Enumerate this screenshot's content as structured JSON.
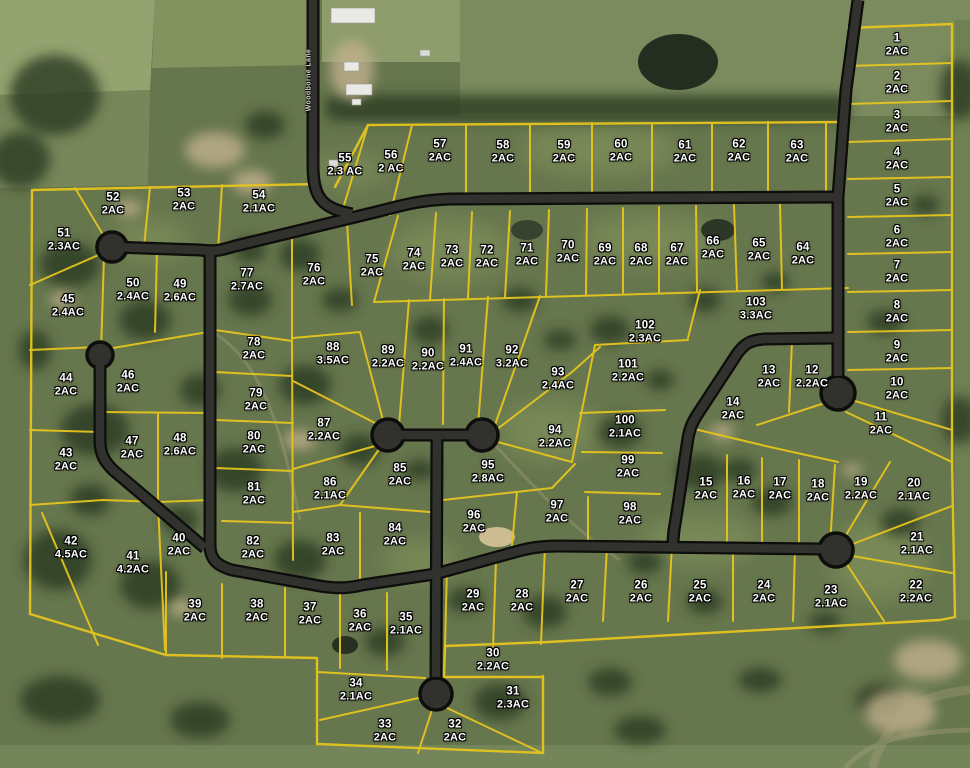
{
  "map": {
    "road_label": "Woodborne Lane"
  },
  "lots": [
    {
      "n": "1",
      "area": "2AC",
      "x": 897,
      "y": 45
    },
    {
      "n": "2",
      "area": "2AC",
      "x": 897,
      "y": 83
    },
    {
      "n": "3",
      "area": "2AC",
      "x": 897,
      "y": 122
    },
    {
      "n": "4",
      "area": "2AC",
      "x": 897,
      "y": 159
    },
    {
      "n": "5",
      "area": "2AC",
      "x": 897,
      "y": 196
    },
    {
      "n": "6",
      "area": "2AC",
      "x": 897,
      "y": 237
    },
    {
      "n": "7",
      "area": "2AC",
      "x": 897,
      "y": 272
    },
    {
      "n": "8",
      "area": "2AC",
      "x": 897,
      "y": 312
    },
    {
      "n": "9",
      "area": "2AC",
      "x": 897,
      "y": 352
    },
    {
      "n": "10",
      "area": "2AC",
      "x": 897,
      "y": 389
    },
    {
      "n": "11",
      "area": "2AC",
      "x": 881,
      "y": 424
    },
    {
      "n": "12",
      "area": "2.2AC",
      "x": 812,
      "y": 377
    },
    {
      "n": "13",
      "area": "2AC",
      "x": 769,
      "y": 377
    },
    {
      "n": "14",
      "area": "2AC",
      "x": 733,
      "y": 409
    },
    {
      "n": "15",
      "area": "2AC",
      "x": 706,
      "y": 489
    },
    {
      "n": "16",
      "area": "2AC",
      "x": 744,
      "y": 488
    },
    {
      "n": "17",
      "area": "2AC",
      "x": 780,
      "y": 489
    },
    {
      "n": "18",
      "area": "2AC",
      "x": 818,
      "y": 491
    },
    {
      "n": "19",
      "area": "2.2AC",
      "x": 861,
      "y": 489
    },
    {
      "n": "20",
      "area": "2.1AC",
      "x": 914,
      "y": 490
    },
    {
      "n": "21",
      "area": "2.1AC",
      "x": 917,
      "y": 544
    },
    {
      "n": "22",
      "area": "2.2AC",
      "x": 916,
      "y": 592
    },
    {
      "n": "23",
      "area": "2.1AC",
      "x": 831,
      "y": 597
    },
    {
      "n": "24",
      "area": "2AC",
      "x": 764,
      "y": 592
    },
    {
      "n": "25",
      "area": "2AC",
      "x": 700,
      "y": 592
    },
    {
      "n": "26",
      "area": "2AC",
      "x": 641,
      "y": 592
    },
    {
      "n": "27",
      "area": "2AC",
      "x": 577,
      "y": 592
    },
    {
      "n": "28",
      "area": "2AC",
      "x": 522,
      "y": 601
    },
    {
      "n": "29",
      "area": "2AC",
      "x": 473,
      "y": 601
    },
    {
      "n": "30",
      "area": "2.2AC",
      "x": 493,
      "y": 660
    },
    {
      "n": "31",
      "area": "2.3AC",
      "x": 513,
      "y": 698
    },
    {
      "n": "32",
      "area": "2AC",
      "x": 455,
      "y": 731
    },
    {
      "n": "33",
      "area": "2AC",
      "x": 385,
      "y": 731
    },
    {
      "n": "34",
      "area": "2.1AC",
      "x": 356,
      "y": 690
    },
    {
      "n": "35",
      "area": "2.1AC",
      "x": 406,
      "y": 624
    },
    {
      "n": "36",
      "area": "2AC",
      "x": 360,
      "y": 621
    },
    {
      "n": "37",
      "area": "2AC",
      "x": 310,
      "y": 614
    },
    {
      "n": "38",
      "area": "2AC",
      "x": 257,
      "y": 611
    },
    {
      "n": "39",
      "area": "2AC",
      "x": 195,
      "y": 611
    },
    {
      "n": "40",
      "area": "2AC",
      "x": 179,
      "y": 545
    },
    {
      "n": "41",
      "area": "4.2AC",
      "x": 133,
      "y": 563
    },
    {
      "n": "42",
      "area": "4.5AC",
      "x": 71,
      "y": 548
    },
    {
      "n": "43",
      "area": "2AC",
      "x": 66,
      "y": 460
    },
    {
      "n": "44",
      "area": "2AC",
      "x": 66,
      "y": 385
    },
    {
      "n": "45",
      "area": "2.4AC",
      "x": 68,
      "y": 306
    },
    {
      "n": "46",
      "area": "2AC",
      "x": 128,
      "y": 382
    },
    {
      "n": "47",
      "area": "2AC",
      "x": 132,
      "y": 448
    },
    {
      "n": "48",
      "area": "2.6AC",
      "x": 180,
      "y": 445
    },
    {
      "n": "49",
      "area": "2.6AC",
      "x": 180,
      "y": 291
    },
    {
      "n": "50",
      "area": "2.4AC",
      "x": 133,
      "y": 290
    },
    {
      "n": "51",
      "area": "2.3AC",
      "x": 64,
      "y": 240
    },
    {
      "n": "52",
      "area": "2AC",
      "x": 113,
      "y": 204
    },
    {
      "n": "53",
      "area": "2AC",
      "x": 184,
      "y": 200
    },
    {
      "n": "54",
      "area": "2.1AC",
      "x": 259,
      "y": 202
    },
    {
      "n": "55",
      "area": "2.3 AC",
      "x": 345,
      "y": 165
    },
    {
      "n": "56",
      "area": "2 AC",
      "x": 391,
      "y": 162
    },
    {
      "n": "57",
      "area": "2AC",
      "x": 440,
      "y": 151
    },
    {
      "n": "58",
      "area": "2AC",
      "x": 503,
      "y": 152
    },
    {
      "n": "59",
      "area": "2AC",
      "x": 564,
      "y": 152
    },
    {
      "n": "60",
      "area": "2AC",
      "x": 621,
      "y": 151
    },
    {
      "n": "61",
      "area": "2AC",
      "x": 685,
      "y": 152
    },
    {
      "n": "62",
      "area": "2AC",
      "x": 739,
      "y": 151
    },
    {
      "n": "63",
      "area": "2AC",
      "x": 797,
      "y": 152
    },
    {
      "n": "64",
      "area": "2AC",
      "x": 803,
      "y": 254
    },
    {
      "n": "65",
      "area": "2AC",
      "x": 759,
      "y": 250
    },
    {
      "n": "66",
      "area": "2AC",
      "x": 713,
      "y": 248
    },
    {
      "n": "67",
      "area": "2AC",
      "x": 677,
      "y": 255
    },
    {
      "n": "68",
      "area": "2AC",
      "x": 641,
      "y": 255
    },
    {
      "n": "69",
      "area": "2AC",
      "x": 605,
      "y": 255
    },
    {
      "n": "70",
      "area": "2AC",
      "x": 568,
      "y": 252
    },
    {
      "n": "71",
      "area": "2AC",
      "x": 527,
      "y": 255
    },
    {
      "n": "72",
      "area": "2AC",
      "x": 487,
      "y": 257
    },
    {
      "n": "73",
      "area": "2AC",
      "x": 452,
      "y": 257
    },
    {
      "n": "74",
      "area": "2AC",
      "x": 414,
      "y": 260
    },
    {
      "n": "75",
      "area": "2AC",
      "x": 372,
      "y": 266
    },
    {
      "n": "76",
      "area": "2AC",
      "x": 314,
      "y": 275
    },
    {
      "n": "77",
      "area": "2.7AC",
      "x": 247,
      "y": 280
    },
    {
      "n": "78",
      "area": "2AC",
      "x": 254,
      "y": 349
    },
    {
      "n": "79",
      "area": "2AC",
      "x": 256,
      "y": 400
    },
    {
      "n": "80",
      "area": "2AC",
      "x": 254,
      "y": 443
    },
    {
      "n": "81",
      "area": "2AC",
      "x": 254,
      "y": 494
    },
    {
      "n": "82",
      "area": "2AC",
      "x": 253,
      "y": 548
    },
    {
      "n": "83",
      "area": "2AC",
      "x": 333,
      "y": 545
    },
    {
      "n": "84",
      "area": "2AC",
      "x": 395,
      "y": 535
    },
    {
      "n": "85",
      "area": "2AC",
      "x": 400,
      "y": 475
    },
    {
      "n": "86",
      "area": "2.1AC",
      "x": 330,
      "y": 489
    },
    {
      "n": "87",
      "area": "2.2AC",
      "x": 324,
      "y": 430
    },
    {
      "n": "88",
      "area": "3.5AC",
      "x": 333,
      "y": 354
    },
    {
      "n": "89",
      "area": "2.2AC",
      "x": 388,
      "y": 357
    },
    {
      "n": "90",
      "area": "2.2AC",
      "x": 428,
      "y": 360
    },
    {
      "n": "91",
      "area": "2.4AC",
      "x": 466,
      "y": 356
    },
    {
      "n": "92",
      "area": "3.2AC",
      "x": 512,
      "y": 357
    },
    {
      "n": "93",
      "area": "2.4AC",
      "x": 558,
      "y": 379
    },
    {
      "n": "94",
      "area": "2.2AC",
      "x": 555,
      "y": 437
    },
    {
      "n": "95",
      "area": "2.8AC",
      "x": 488,
      "y": 472
    },
    {
      "n": "96",
      "area": "2AC",
      "x": 474,
      "y": 522
    },
    {
      "n": "97",
      "area": "2AC",
      "x": 557,
      "y": 512
    },
    {
      "n": "98",
      "area": "2AC",
      "x": 630,
      "y": 514
    },
    {
      "n": "99",
      "area": "2AC",
      "x": 628,
      "y": 467
    },
    {
      "n": "100",
      "area": "2.1AC",
      "x": 625,
      "y": 427
    },
    {
      "n": "101",
      "area": "2.2AC",
      "x": 628,
      "y": 371
    },
    {
      "n": "102",
      "area": "2.3AC",
      "x": 645,
      "y": 332
    },
    {
      "n": "103",
      "area": "3.3AC",
      "x": 756,
      "y": 309
    }
  ]
}
